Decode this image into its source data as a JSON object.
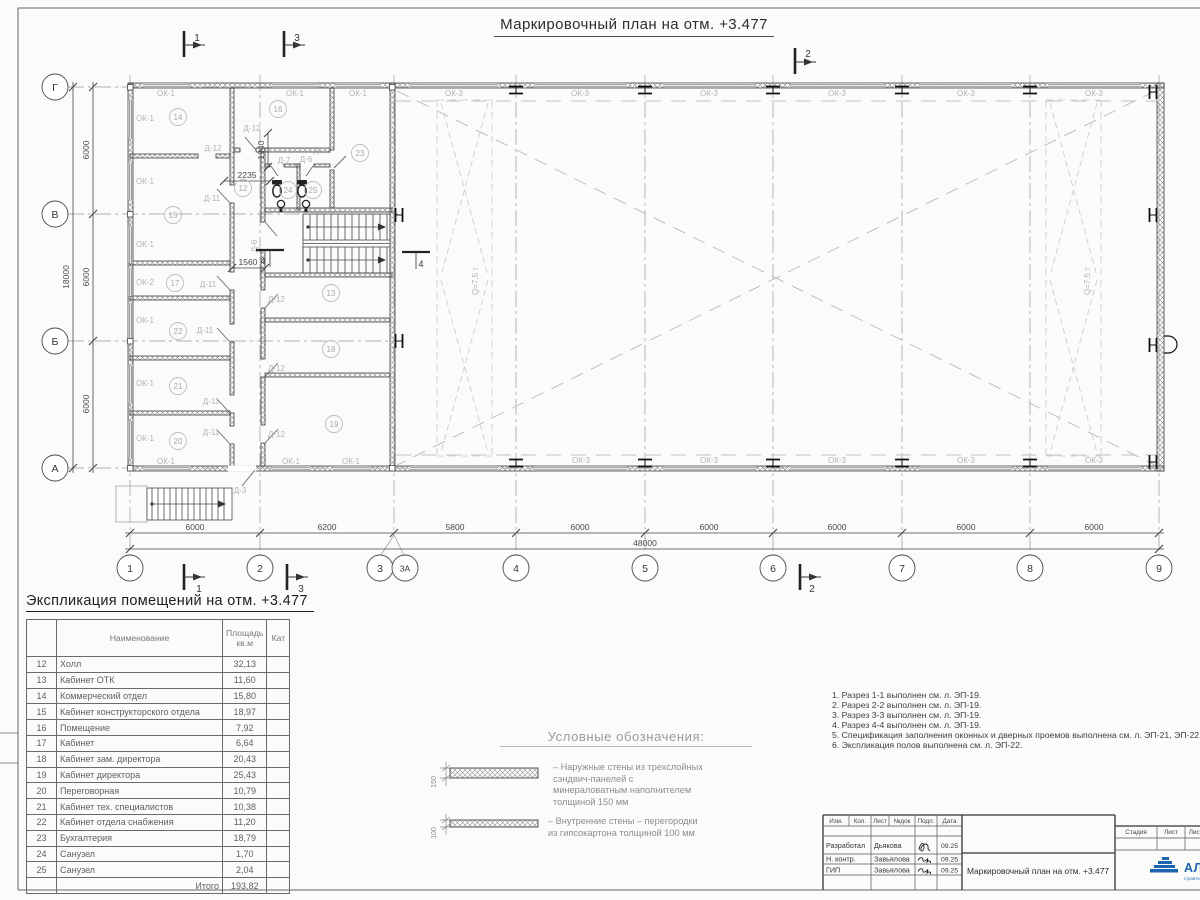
{
  "plan": {
    "title": "Маркировочный план на отм. +3.477",
    "axes_bottom": [
      "1",
      "2",
      "3",
      "3А",
      "4",
      "5",
      "6",
      "7",
      "8",
      "9"
    ],
    "axes_left": [
      "Г",
      "В",
      "Б",
      "А"
    ],
    "dims_bottom": [
      "6000",
      "6200",
      "5800",
      "6000",
      "6000",
      "6000",
      "6000",
      "6000"
    ],
    "dim_total_bottom": "48000",
    "dims_left": [
      "6000",
      "6000",
      "6000"
    ],
    "dim_total_left": "18000",
    "dim_2235": "2235",
    "dim_1940": "1940",
    "dim_1560": "1560",
    "labels": {
      "ok1": "ОК-1",
      "ok2": "ОК-2",
      "ok3": "ОК-3",
      "d12": "Д-12",
      "d11": "Д-11",
      "d7": "Д-7",
      "d6": "Д-6",
      "d3": "Д-3",
      "crane": "Q=7,5 т"
    },
    "sections": {
      "s1": "1",
      "s2": "2",
      "s3": "3",
      "s4": "4"
    },
    "rooms": {
      "12": "12",
      "13": "13",
      "14": "14",
      "15": "15",
      "16": "16",
      "17": "17",
      "18": "18",
      "19": "19",
      "20": "20",
      "21": "21",
      "22": "22",
      "23": "23",
      "24": "24",
      "25": "25"
    }
  },
  "schedule": {
    "title": "Экспликация помещений на отм. +3.477",
    "col_name": "Наименование",
    "col_area": "Площадь кв.м",
    "col_cat": "Кат",
    "rows": [
      {
        "num": "12",
        "name": "Холл",
        "area": "32,13"
      },
      {
        "num": "13",
        "name": "Кабинет ОТК",
        "area": "11,60"
      },
      {
        "num": "14",
        "name": "Коммерческий отдел",
        "area": "15,80"
      },
      {
        "num": "15",
        "name": "Кабинет конструкторского отдела",
        "area": "18,97"
      },
      {
        "num": "16",
        "name": "Помещение",
        "area": "7,92"
      },
      {
        "num": "17",
        "name": "Кабинет",
        "area": "6,64"
      },
      {
        "num": "18",
        "name": "Кабинет зам. директора",
        "area": "20,43"
      },
      {
        "num": "19",
        "name": "Кабинет директора",
        "area": "25,43"
      },
      {
        "num": "20",
        "name": "Переговорная",
        "area": "10,79"
      },
      {
        "num": "21",
        "name": "Кабинет тех. специалистов",
        "area": "10,38"
      },
      {
        "num": "22",
        "name": "Кабинет отдела снабжения",
        "area": "11,20"
      },
      {
        "num": "23",
        "name": "Бухгалтерия",
        "area": "18,79"
      },
      {
        "num": "24",
        "name": "Санузел",
        "area": "1,70"
      },
      {
        "num": "25",
        "name": "Санузел",
        "area": "2,04"
      }
    ],
    "total_label": "Итого",
    "total_value": "193,82"
  },
  "legend": {
    "title": "Условные обозначения:",
    "items": [
      {
        "dim": "150",
        "text": "– Наружные стены из трехслойных сэндвич-панелей с минераловатным наполнителем толщиной 150 мм"
      },
      {
        "dim": "100",
        "text": "– Внутренние стены – перегородки из гипсокартона толщиной 100 мм"
      }
    ]
  },
  "notes": [
    "1. Разрез 1-1 выполнен см. л. ЭП-19.",
    "2. Разрез 2-2 выполнен см. л. ЭП-19.",
    "3. Разрез 3-3 выполнен см. л. ЭП-19.",
    "4. Разрез 4-4 выполнен см. л. ЭП-19.",
    "5. Спецификация заполнения оконных и дверных проемов выполнена см. л. ЭП-21, ЭП-22.",
    "6. Экспликация полов выполнена см. л. ЭП-22."
  ],
  "titleblock": {
    "cols": {
      "izm": "Изм.",
      "kol": "Кол.",
      "list": "Лист",
      "ndok": "№док",
      "podp": "Подп.",
      "data": "Дата"
    },
    "rows": [
      {
        "role": "Разработал",
        "name": "Дьякова",
        "date": "09.25"
      },
      {
        "role": "Н. контр.",
        "name": "Завьялова",
        "date": "09.25"
      },
      {
        "role": "ГИП",
        "name": "Завьялова",
        "date": "09.25"
      }
    ],
    "doc_title": "Маркировочный план на отм. +3.477",
    "stage": "Стадия",
    "sheet": "Лист",
    "sheets": "Листов",
    "logo": "АЛЬЯНС",
    "logo_tagline": "строительная компания"
  }
}
